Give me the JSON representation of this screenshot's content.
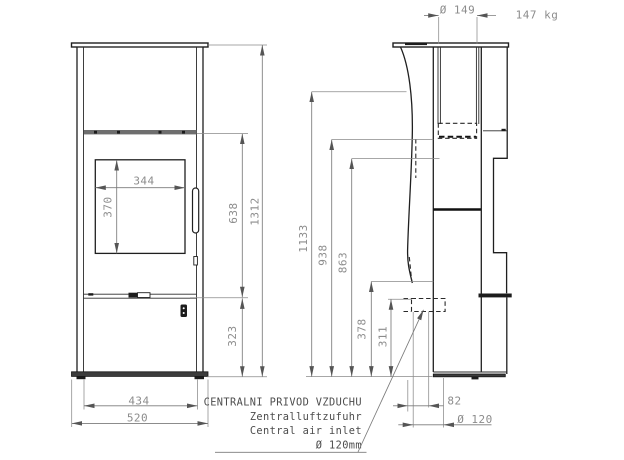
{
  "note": {
    "line1": "CENTRALNI PRIVOD VZDUCHU",
    "line2": "Zentralluftzufuhr",
    "line3": "Central air inlet",
    "line4": "Ø 120mm"
  },
  "weight_label": "147 kg",
  "dimensions": {
    "flue_diameter": "Ø 149",
    "glass_width": "344",
    "glass_height": "370",
    "firebox_section_height": "638",
    "overall_height": "1312",
    "lower_section_height": "323",
    "body_width": "434",
    "overall_width": "520",
    "side_height_total": "1133",
    "side_height_flue_bottom": "938",
    "side_height_863": "863",
    "side_height_378": "378",
    "side_height_inlet": "311",
    "inlet_center_offset": "82",
    "inlet_diameter": "Ø 120"
  },
  "colors": {
    "background": "#ffffff",
    "object_line": "#1f1f1f",
    "dimension_line": "#7b7b7b",
    "dimension_text": "#8c8c8c",
    "note_text": "#4c4c4c"
  }
}
